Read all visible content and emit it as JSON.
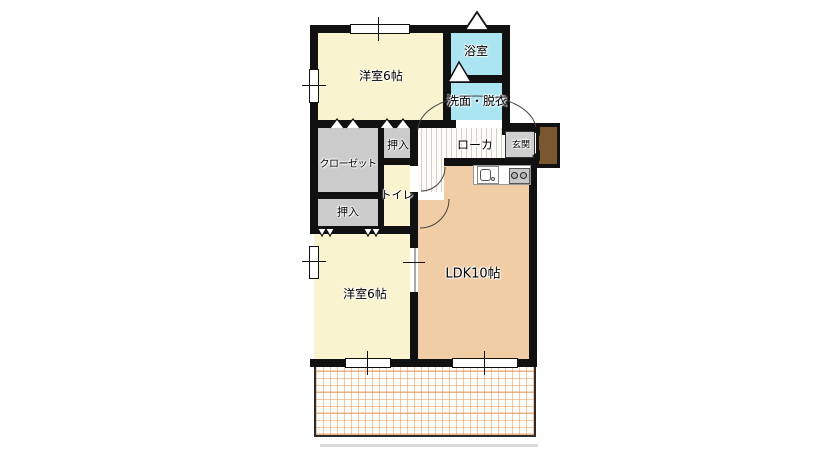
{
  "plan": {
    "title": "2LDK apartment floor plan",
    "rooms": {
      "western_top": {
        "label": "洋室6帖"
      },
      "bath": {
        "label": "浴室"
      },
      "washroom": {
        "label": "洗面・脱衣"
      },
      "closet": {
        "label": "クローゼット"
      },
      "oshiire_upper": {
        "label": "押入"
      },
      "toilet": {
        "label": "トイレ"
      },
      "oshiire_lower": {
        "label": "押入"
      },
      "corridor": {
        "label": "ローカ"
      },
      "entrance": {
        "label": "玄関"
      },
      "ldk": {
        "label": "LDK10帖"
      },
      "western_bottom": {
        "label": "洋室6帖"
      }
    },
    "symbols": {
      "north_arrow": "hollow-triangle-up",
      "bath_door": "hollow-triangle-up",
      "folding_door_marks": "double-triangle-up",
      "oshiire_door_marks": "double-triangle-down",
      "entry_door_arrows": "black-wedge-left",
      "door_swings": "quarter-circle-arc",
      "kitchen": [
        "sink",
        "stove-2-burner"
      ],
      "balcony": "orange-grid"
    },
    "colors": {
      "wall": "#111111",
      "western_room": "#FAF3CF",
      "wet_area": "#ABE5F1",
      "ldk": "#F1CDA5",
      "storage": "#CBCBCB",
      "entrance_floor": "#CFCFCF",
      "entry_door": "#7A572E",
      "balcony_grid": "#E8A468",
      "corridor_stripe": "#DCD9D4"
    }
  }
}
